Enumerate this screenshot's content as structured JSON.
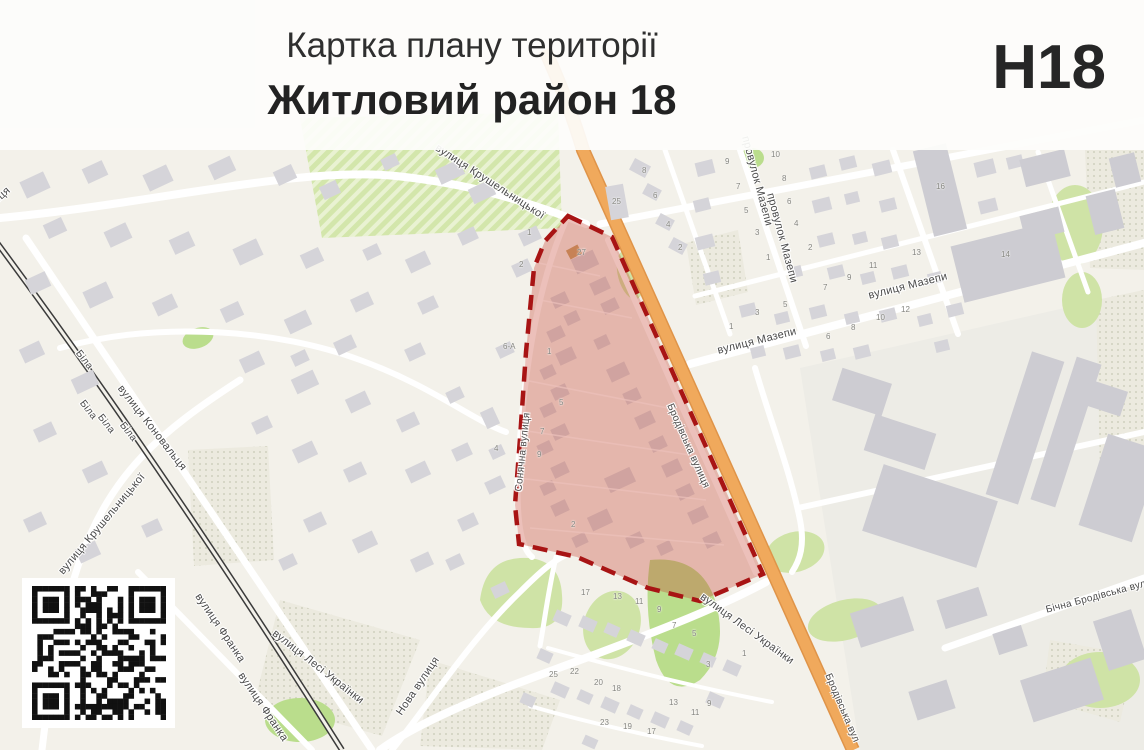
{
  "header": {
    "title": "Картка плану території",
    "subtitle": "Житловий район 18",
    "code": "Н18"
  },
  "map": {
    "background_color": "#f3f1ea",
    "highlight_fill_color": "#c6402f",
    "highlight_border_color": "#a81414",
    "main_road_color": "#f0a95c",
    "railway_color": "#3b3b3b",
    "green_color": "#cfe3a6",
    "building_color": "#d5d4d9",
    "street_labels": [
      {
        "text": "вулиця Крушельницької",
        "x": 490,
        "y": 182,
        "rot": 33,
        "size": 11
      },
      {
        "text": "вулиця Коновальця",
        "x": 152,
        "y": 428,
        "rot": 52,
        "size": 11
      },
      {
        "text": "вулиця Коновальця",
        "x": -30,
        "y": 224,
        "rot": -42,
        "size": 11
      },
      {
        "text": "вулиця Крушельницької",
        "x": 102,
        "y": 524,
        "rot": -50,
        "size": 11
      },
      {
        "text": "Біла",
        "x": 84,
        "y": 360,
        "rot": 52,
        "size": 10
      },
      {
        "text": "Біла",
        "x": 88,
        "y": 410,
        "rot": 52,
        "size": 10
      },
      {
        "text": "Біла",
        "x": 106,
        "y": 424,
        "rot": 52,
        "size": 10
      },
      {
        "text": "Біла",
        "x": 128,
        "y": 432,
        "rot": 52,
        "size": 10
      },
      {
        "text": "вулиця Франка",
        "x": 220,
        "y": 628,
        "rot": 56,
        "size": 11
      },
      {
        "text": "вулиця Франка",
        "x": 263,
        "y": 707,
        "rot": 56,
        "size": 11
      },
      {
        "text": "вулиця Лесі Українки",
        "x": 318,
        "y": 667,
        "rot": 38,
        "size": 11
      },
      {
        "text": "вулиця Лесі Українки",
        "x": 747,
        "y": 629,
        "rot": 36,
        "size": 11
      },
      {
        "text": "Нова вулиця",
        "x": 418,
        "y": 686,
        "rot": -56,
        "size": 11
      },
      {
        "text": "вулиця Мазепи",
        "x": 757,
        "y": 341,
        "rot": -14,
        "size": 11
      },
      {
        "text": "вулиця Мазепи",
        "x": 908,
        "y": 286,
        "rot": -14,
        "size": 11
      },
      {
        "text": "провулок Мазепи",
        "x": 757,
        "y": 181,
        "rot": 75,
        "size": 11
      },
      {
        "text": "провулок Мазепи",
        "x": 782,
        "y": 238,
        "rot": 75,
        "size": 11
      },
      {
        "text": "Сонячна вулиця",
        "x": 523,
        "y": 452,
        "rot": -84,
        "size": 10
      },
      {
        "text": "Бродівська вулиця",
        "x": 688,
        "y": 446,
        "rot": 66,
        "size": 10
      },
      {
        "text": "Бродівська вул",
        "x": 842,
        "y": 708,
        "rot": 67,
        "size": 10
      },
      {
        "text": "Бічна Бродівська вул",
        "x": 1096,
        "y": 597,
        "rot": -15,
        "size": 10
      }
    ],
    "house_numbers": [
      {
        "n": "27",
        "x": 583,
        "y": 253
      },
      {
        "n": "1",
        "x": 533,
        "y": 233
      },
      {
        "n": "2",
        "x": 525,
        "y": 265
      },
      {
        "n": "6-А",
        "x": 509,
        "y": 347
      },
      {
        "n": "4",
        "x": 500,
        "y": 449
      },
      {
        "n": "1",
        "x": 553,
        "y": 352
      },
      {
        "n": "5",
        "x": 565,
        "y": 403
      },
      {
        "n": "7",
        "x": 546,
        "y": 432
      },
      {
        "n": "9",
        "x": 543,
        "y": 455
      },
      {
        "n": "2",
        "x": 577,
        "y": 525
      },
      {
        "n": "25",
        "x": 618,
        "y": 202
      },
      {
        "n": "8",
        "x": 648,
        "y": 171
      },
      {
        "n": "6",
        "x": 659,
        "y": 196
      },
      {
        "n": "4",
        "x": 672,
        "y": 225
      },
      {
        "n": "2",
        "x": 684,
        "y": 248
      },
      {
        "n": "10",
        "x": 777,
        "y": 155
      },
      {
        "n": "9",
        "x": 731,
        "y": 162
      },
      {
        "n": "8",
        "x": 788,
        "y": 179
      },
      {
        "n": "7",
        "x": 742,
        "y": 187
      },
      {
        "n": "6",
        "x": 793,
        "y": 202
      },
      {
        "n": "5",
        "x": 750,
        "y": 211
      },
      {
        "n": "4",
        "x": 800,
        "y": 224
      },
      {
        "n": "3",
        "x": 761,
        "y": 233
      },
      {
        "n": "2",
        "x": 814,
        "y": 248
      },
      {
        "n": "1",
        "x": 772,
        "y": 258
      },
      {
        "n": "16",
        "x": 942,
        "y": 187
      },
      {
        "n": "14",
        "x": 1007,
        "y": 255
      },
      {
        "n": "13",
        "x": 918,
        "y": 253
      },
      {
        "n": "11",
        "x": 875,
        "y": 266
      },
      {
        "n": "9",
        "x": 853,
        "y": 278
      },
      {
        "n": "7",
        "x": 829,
        "y": 288
      },
      {
        "n": "5",
        "x": 789,
        "y": 305
      },
      {
        "n": "3",
        "x": 761,
        "y": 313
      },
      {
        "n": "1",
        "x": 735,
        "y": 327
      },
      {
        "n": "12",
        "x": 907,
        "y": 310
      },
      {
        "n": "10",
        "x": 882,
        "y": 318
      },
      {
        "n": "8",
        "x": 857,
        "y": 328
      },
      {
        "n": "6",
        "x": 832,
        "y": 337
      },
      {
        "n": "17",
        "x": 587,
        "y": 593
      },
      {
        "n": "13",
        "x": 619,
        "y": 597
      },
      {
        "n": "11",
        "x": 641,
        "y": 602
      },
      {
        "n": "9",
        "x": 663,
        "y": 610
      },
      {
        "n": "7",
        "x": 678,
        "y": 626
      },
      {
        "n": "5",
        "x": 698,
        "y": 634
      },
      {
        "n": "3",
        "x": 712,
        "y": 665
      },
      {
        "n": "1",
        "x": 748,
        "y": 654
      },
      {
        "n": "25",
        "x": 555,
        "y": 675
      },
      {
        "n": "22",
        "x": 576,
        "y": 672
      },
      {
        "n": "20",
        "x": 600,
        "y": 683
      },
      {
        "n": "18",
        "x": 618,
        "y": 689
      },
      {
        "n": "13",
        "x": 675,
        "y": 703
      },
      {
        "n": "11",
        "x": 697,
        "y": 713
      },
      {
        "n": "9",
        "x": 713,
        "y": 704
      },
      {
        "n": "23",
        "x": 606,
        "y": 723
      },
      {
        "n": "19",
        "x": 629,
        "y": 727
      },
      {
        "n": "17",
        "x": 653,
        "y": 732
      }
    ],
    "qr_code": {
      "present": true
    }
  }
}
